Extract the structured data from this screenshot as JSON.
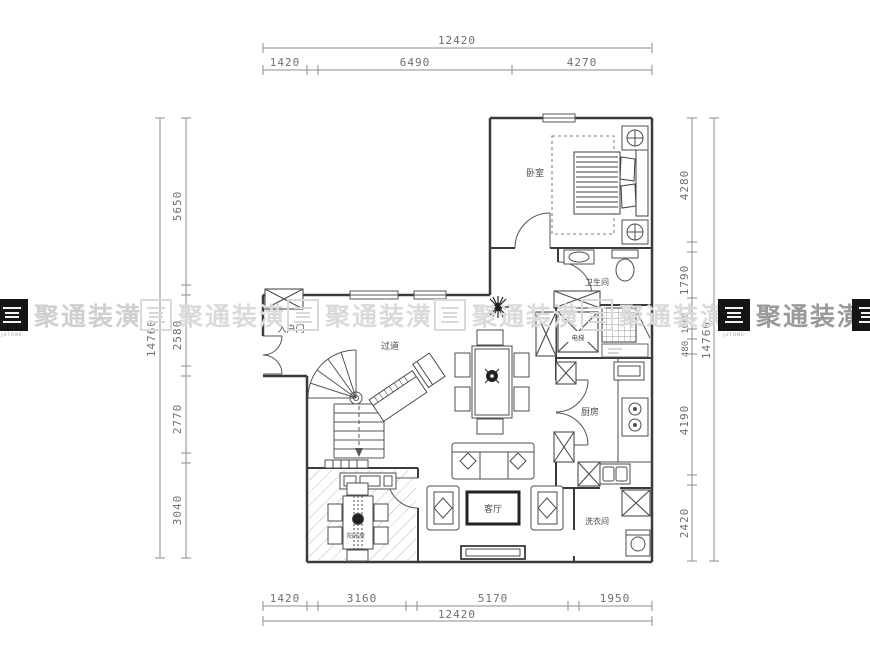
{
  "watermark": {
    "brand": "聚通装潢",
    "sub": "JUTONE",
    "light_color": "#dadada",
    "dark_color": "#151515"
  },
  "dims": {
    "top": {
      "total": "12420",
      "segments": [
        "1420",
        "6490",
        "4270"
      ]
    },
    "bottom": {
      "total": "12420",
      "segments": [
        "1420",
        "3160",
        "5170",
        "1950"
      ]
    },
    "left": {
      "total": "14760",
      "segments": [
        "5650",
        "2580",
        "2770",
        "3040"
      ]
    },
    "right": {
      "total": "14760",
      "segments": [
        "4280",
        "1790",
        "1000",
        "480",
        "4190",
        "2420"
      ]
    }
  },
  "rooms": {
    "bedroom": "卧室",
    "bathroom": "卫生间",
    "elevator": "电梯",
    "kitchen": "厨房",
    "hallway": "过道",
    "entry": "入户门",
    "living": "客厅",
    "laundry": "洗衣间",
    "sunroom": "阳光房"
  }
}
